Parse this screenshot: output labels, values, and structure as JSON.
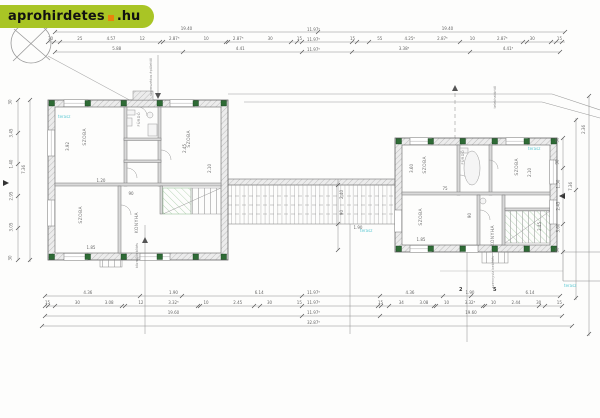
{
  "logo": {
    "brand": "aprohirdetes",
    "tld": ".hu"
  },
  "colors": {
    "logo_green": "#a9c525",
    "logo_orange": "#e8830c",
    "column_green": "#2e6b35",
    "line_gray": "#8c8c8c",
    "cyan_label": "#5bc8d2"
  },
  "dims": {
    "top_total_left": "19.40",
    "top_total_right": "19.40",
    "top_segments_left": [
      "30",
      "25",
      "4.57",
      "12",
      "2.87⁵",
      "10",
      "2.87⁵",
      "30",
      "15"
    ],
    "top_segments_right": [
      "15",
      "55",
      "4.25⁵",
      "2.87⁵",
      "10",
      "2.87⁵",
      "30",
      "15"
    ],
    "top_sub_left": [
      "5.88",
      "4.41"
    ],
    "top_sub_right": [
      "3.38⁵",
      "4.41⁵"
    ],
    "top_stack": [
      "11.97⁵",
      "11.97⁵",
      "11.97⁵"
    ],
    "bottom_openings_left": [
      "4.36",
      "1.90",
      "6.14"
    ],
    "bottom_openings_right": [
      "4.36",
      "1.90",
      "6.14"
    ],
    "bottom_segments_left": [
      "15",
      "30",
      "3.08",
      "12",
      "3.32⁵",
      "10",
      "2.45",
      "30",
      "15"
    ],
    "bottom_segments_right": [
      "15",
      "34",
      "3.08",
      "10",
      "3.32⁵",
      "10",
      "2.44",
      "30",
      "15"
    ],
    "bottom_total_left": "19.60",
    "bottom_total_right": "19.60",
    "bottom_stack": [
      "11.97⁵",
      "11.97⁵",
      "11.97⁵",
      "32.87⁵"
    ],
    "left_chain": [
      "30",
      "3.45",
      "1.40",
      "2.95",
      "3.05",
      "30"
    ],
    "right_chain_inner": [
      "30",
      "90",
      "1.50",
      "2.45",
      "3.60",
      "30"
    ],
    "right_chain_outer": [
      "7.36",
      "2.36"
    ],
    "corridor": [
      "2.40",
      "90",
      "1.90"
    ],
    "interior_left": [
      "3.92",
      "1.20",
      "2.45",
      "90",
      "1.85",
      "2.10"
    ],
    "interior_right": [
      "3.60",
      "75",
      "2.10",
      "1.85",
      "90",
      "2.45"
    ]
  },
  "rooms": {
    "left": [
      "SZOBA",
      "SZOBA",
      "SZOBA",
      "KONYHA",
      "FÜRDŐ"
    ],
    "right": [
      "SZOBA",
      "SZOBA",
      "SZOBA",
      "KONYHA",
      "FÜRDŐ"
    ]
  },
  "notes": {
    "mid_top": "szomszédos épülettől",
    "right_top": "telekhatártól",
    "below_left": "közműbekötés",
    "below_right": "szennyvíz bekötés",
    "terasz": "terasz"
  },
  "sections": [
    "2",
    "5"
  ]
}
